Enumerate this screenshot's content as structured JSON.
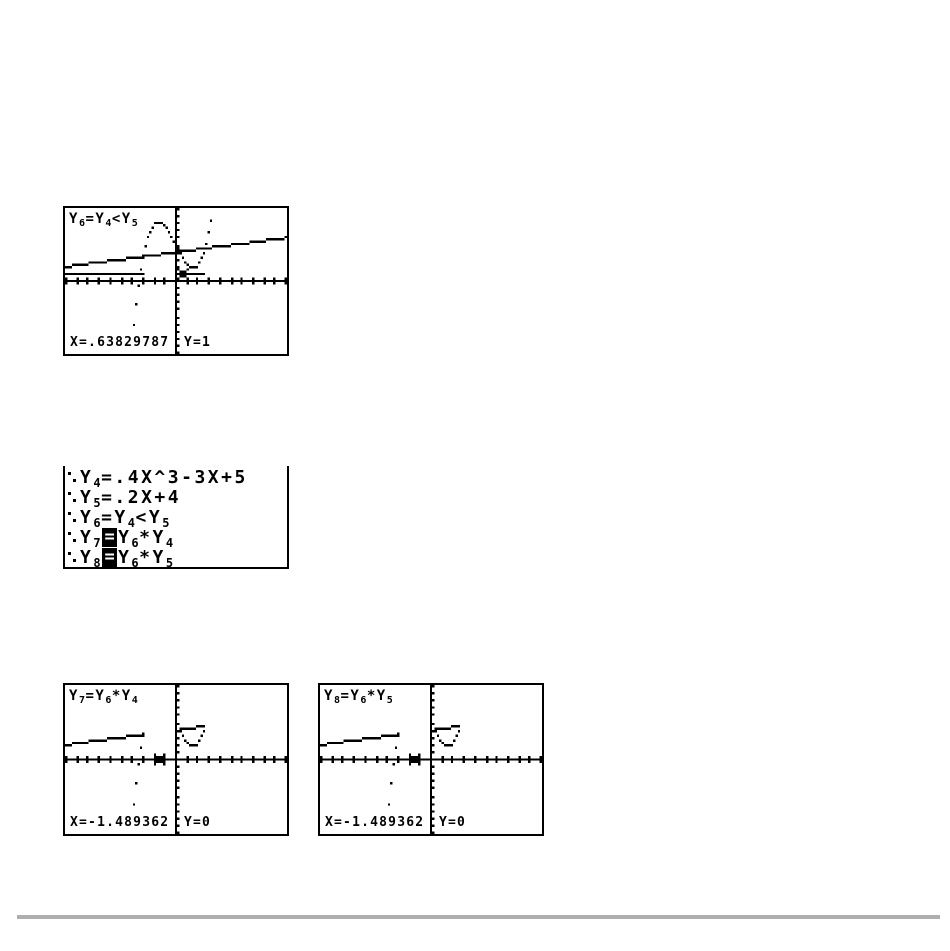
{
  "page": {
    "background": "#ffffff",
    "ink": "#000000",
    "divider_color": "#aeaeae"
  },
  "window": {
    "xmin": -10,
    "xmax": 10,
    "ymin": -10,
    "ymax": 10,
    "xscl": 1,
    "yscl": 1,
    "cols": 95,
    "rows": 63
  },
  "functions": {
    "y4": {
      "type": "poly",
      "coeffs": [
        0.4,
        0,
        -3,
        5
      ],
      "display": ".4X^3-3X+5"
    },
    "y5": {
      "type": "poly",
      "coeffs": [
        0.2,
        4
      ],
      "display": ".2X+4"
    },
    "y6": {
      "type": "less",
      "a": "y4",
      "b": "y5",
      "display": "Y4<Y5"
    },
    "y7": {
      "type": "mul",
      "a": "y6",
      "b": "y4",
      "display": "Y6*Y4"
    },
    "y8": {
      "type": "mul",
      "a": "y6",
      "b": "y5",
      "display": "Y6*Y5"
    }
  },
  "graph_screens": [
    {
      "id": "graph1",
      "title": "Y6=Y4<Y5",
      "plots": [
        "y4",
        "y5",
        "y6"
      ],
      "cursor": {
        "x": 0.63829787,
        "y": 1
      },
      "x_readout": "X=.63829787",
      "y_readout": "Y=1"
    },
    {
      "id": "graph2",
      "title": "Y7=Y6*Y4",
      "plots": [
        "y7",
        "y8"
      ],
      "cursor": {
        "x": -1.489362,
        "y": 0
      },
      "x_readout": "X=-1.489362",
      "y_readout": "Y=0"
    },
    {
      "id": "graph3",
      "title": "Y8=Y6*Y5",
      "plots": [
        "y7",
        "y8"
      ],
      "cursor": {
        "x": -1.489362,
        "y": 0
      },
      "x_readout": "X=-1.489362",
      "y_readout": "Y=0"
    }
  ],
  "editor": {
    "lines": [
      {
        "style_icon": "dot-style-icon",
        "name": "Y4",
        "selected": false,
        "rhs": ".4X^3-3X+5"
      },
      {
        "style_icon": "dot-style-icon",
        "name": "Y5",
        "selected": false,
        "rhs": ".2X+4"
      },
      {
        "style_icon": "dot-style-icon",
        "name": "Y6",
        "selected": false,
        "rhs": "Y4<Y5"
      },
      {
        "style_icon": "dot-style-icon",
        "name": "Y7",
        "selected": true,
        "rhs": "Y6*Y4"
      },
      {
        "style_icon": "dot-style-icon",
        "name": "Y8",
        "selected": true,
        "rhs": "Y6*Y5"
      }
    ],
    "equals_sign": "="
  }
}
